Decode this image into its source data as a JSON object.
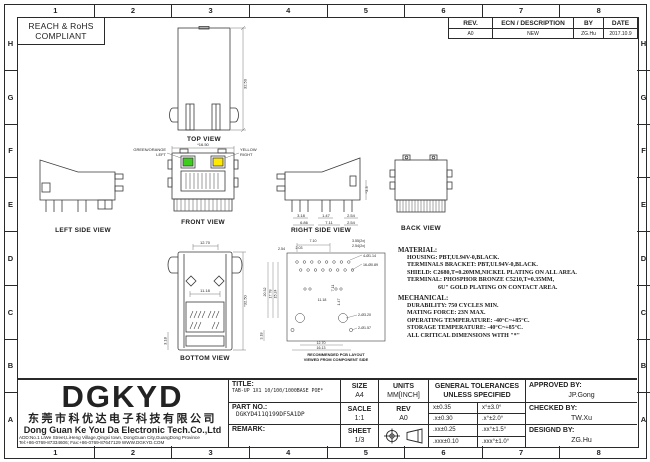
{
  "frame": {
    "columns": [
      "1",
      "2",
      "3",
      "4",
      "5",
      "6",
      "7",
      "8"
    ],
    "rows": [
      "H",
      "G",
      "F",
      "E",
      "D",
      "C",
      "B",
      "A"
    ]
  },
  "compliance": {
    "line1": "REACH & RoHS",
    "line2": "COMPLIANT"
  },
  "revision": {
    "headers": {
      "rev": "REV.",
      "desc": "ECN / DESCRIPTION",
      "by": "BY",
      "date": "DATE"
    },
    "row": {
      "rev": "A0",
      "desc": "NEW",
      "by": "ZG.Hu",
      "date": "2017.10.9"
    }
  },
  "colors": {
    "led_green": "#3ecc1e",
    "led_yellow": "#ffe900"
  },
  "views": {
    "top": {
      "label": "TOP VIEW",
      "height_dim": "32.50"
    },
    "left_side": {
      "label": "LEFT SIDE VIEW"
    },
    "front": {
      "label": "FRONT VIEW",
      "width_dim": "*16.50",
      "led_left_line1": "GREEN/ORANGE",
      "led_left_line2": "LEFT",
      "led_right_line1": "YELLOW",
      "led_right_line2": "RIGHT"
    },
    "right_side": {
      "label": "RIGHT SIDE VIEW",
      "d_318": "3.18",
      "d_686": "6.86",
      "d_147": "1.47",
      "d_711": "7.11",
      "d_254a": "2.54",
      "d_254b": "2.54",
      "height_dim": "*3.3"
    },
    "back": {
      "label": "BACK VIEW"
    },
    "bottom": {
      "label": "BOTTOM VIEW",
      "w_1270": "12.70",
      "w_1118": "11.18",
      "h_3250": "*32.50",
      "h_318": "3.18"
    },
    "pcb": {
      "caption1": "RECOMMENDED PCB LAYOUT",
      "caption2": "VIEWED FROM COMPONENT SIDE",
      "dims": {
        "t_710": "7.10",
        "t_203": "2.03",
        "t_254": "2.54",
        "r_355": "3.55(2x)",
        "r_254": "2.54(2x)",
        "r_d114": "4-Ø1.14",
        "r_d089": "16-Ø0.89",
        "l_2032": "20.32",
        "l_1778": "17.78",
        "l_1524": "15.24",
        "l_318": "3.18",
        "m_1118": "11.18",
        "m_711": "7.11",
        "m_147": "1.47",
        "b_1270": "12.70",
        "b_1613": "16.13",
        "hole_320": "2-Ø3.20",
        "hole_157": "2-Ø1.57"
      }
    }
  },
  "notes": {
    "material": {
      "heading": "MATERIAL:",
      "lines": [
        "HOUSING: PBT,UL94V-0,BLACK.",
        "TERMINALS BRACKET: PBT,UL94V-0,BLACK.",
        "SHIELD: C2680,T=0.20MM,NICKEL PLATING ON ALL AREA.",
        "TERMINAL: PHOSPHOR BRONZE C5210,T=0.35MM,",
        "6U\" GOLD PLATING ON CONTACT AREA."
      ]
    },
    "mechanical": {
      "heading": "MECHANICAL:",
      "lines": [
        "DURABILITY: 750 CYCLES MIN.",
        "MATING FORCE: 23N MAX.",
        "OPERATING TEMPERATURE: -40°C~+85°C.",
        "STORAGE TEMPERATURE: -40°C~+85°C.",
        "ALL CRITICAL DIMENSIONS WITH \"*\""
      ]
    }
  },
  "title_block": {
    "company": {
      "logo": "DGKYD",
      "name_cn": "东莞市科优达电子科技有限公司",
      "name_en": "Dong Guan Ke You Da Electronic Tech.Co.,Ltd",
      "address": "ADD:No.1 LiWe Street,LiHeng Village,Qingxi town, DongGuan City,GuangDong Province",
      "contact": "Tel:+86-0769-87334606; Fax:+86-0769-87647129 WWW.DGKYD.COM"
    },
    "title_label": "TITLE:",
    "title_value": "TAB-UP 1X1 10/100/1000BASE POE*",
    "part_no_label": "PART NO.:",
    "part_no_value": "DGKYD411Q199DF5A1DP",
    "remark_label": "REMARK:",
    "size_label": "SIZE",
    "size_value": "A4",
    "units_label": "UNITS",
    "units_value": "MM[INCH]",
    "scale_label": "SACLE",
    "scale_value": "1:1",
    "rev_label": "REV",
    "rev_value": "A0",
    "sheet_label": "SHEET",
    "sheet_value": "1/3",
    "tolerances": {
      "header1": "GENERAL TOLERANCES",
      "header2": "UNLESS SPECIFIED",
      "rows": [
        [
          "x±0.35",
          "x°±3.0°"
        ],
        [
          ".x±0.30",
          ".x°±2.0°"
        ],
        [
          ".xx±0.25",
          ".xx°±1.5°"
        ],
        [
          ".xxx±0.10",
          ".xxx°±1.0°"
        ]
      ]
    },
    "approved_label": "APPROVED BY:",
    "approved_value": "JP.Gong",
    "checked_label": "CHECKED BY:",
    "checked_value": "TW.Xu",
    "designed_label": "DESIGND BY:",
    "designed_value": "ZG.Hu"
  }
}
